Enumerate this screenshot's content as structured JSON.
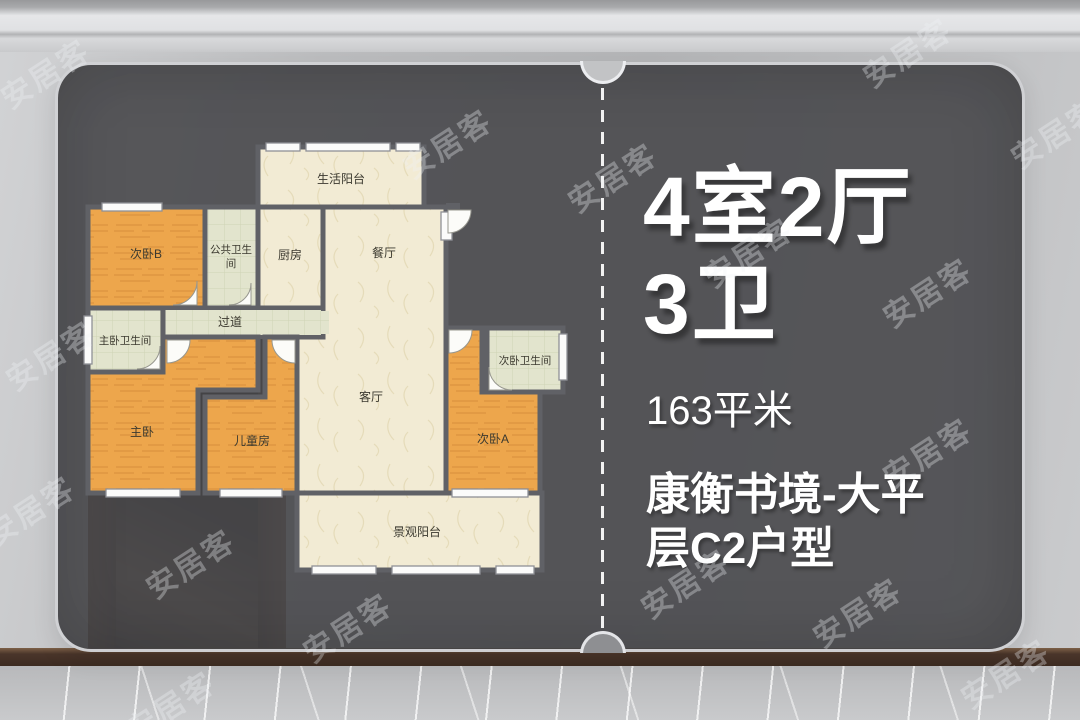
{
  "watermark": {
    "text": "安居客"
  },
  "panel": {
    "title_line1": "4室2厅",
    "title_line2": "3卫",
    "area": "163平米",
    "name_line1": "康衡书境-大平",
    "name_line2": "层C2户型"
  },
  "floorplan": {
    "rooms": [
      {
        "id": "balcony-top",
        "label": "生活阳台"
      },
      {
        "id": "bedroom-b",
        "label": "次卧B"
      },
      {
        "id": "public-bath",
        "label": "公共卫生间",
        "line1": "公共卫生",
        "line2": "间"
      },
      {
        "id": "kitchen",
        "label": "厨房"
      },
      {
        "id": "dining",
        "label": "餐厅"
      },
      {
        "id": "living",
        "label": "客厅"
      },
      {
        "id": "hallway",
        "label": "过道"
      },
      {
        "id": "master-bath",
        "label": "主卧卫生间"
      },
      {
        "id": "master-bedroom",
        "label": "主卧"
      },
      {
        "id": "kids-room",
        "label": "儿童房"
      },
      {
        "id": "bedroom-a-bath",
        "label": "次卧卫生间"
      },
      {
        "id": "bedroom-a",
        "label": "次卧A"
      },
      {
        "id": "balcony-bottom",
        "label": "景观阳台"
      }
    ]
  },
  "colors": {
    "card_bg": "#49494d",
    "wall_line": "#606166",
    "room_orange": "#eda64c",
    "room_cream": "#f2ebd4",
    "room_green": "#e2e4cd",
    "text_white": "#ffffff"
  }
}
